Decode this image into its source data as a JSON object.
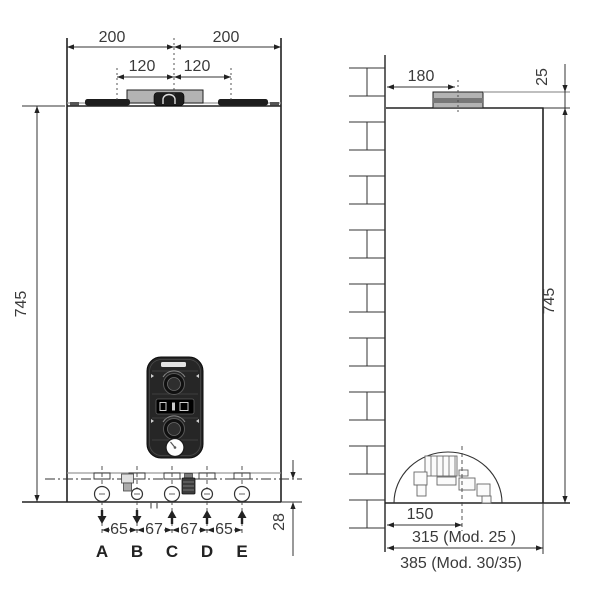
{
  "front": {
    "w_left": "200",
    "w_right": "200",
    "flue_left": "120",
    "flue_right": "120",
    "height": "745",
    "spacings": [
      "65",
      "67",
      "67",
      "65"
    ],
    "ports": [
      "A",
      "B",
      "C",
      "D",
      "E"
    ],
    "pipe_axis_offset": "28"
  },
  "side": {
    "flue_from_wall": "180",
    "flue_above_top": "25",
    "height": "745",
    "center_from_wall": "150",
    "depth_mod25": "315 (Mod. 25  )",
    "depth_mod30": "385 (Mod. 30/35)"
  },
  "colors": {
    "line": "#333333",
    "metal_gray": "#b3b3b3",
    "metal_dark": "#777777",
    "panel_dark": "#262626"
  }
}
